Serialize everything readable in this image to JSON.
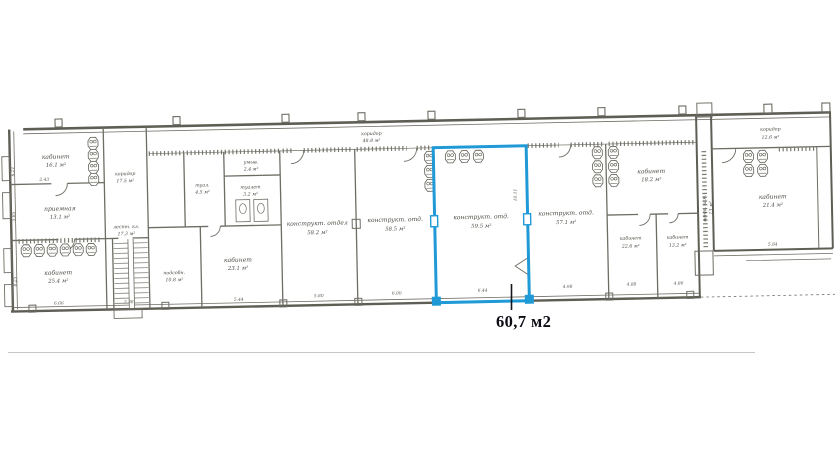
{
  "highlight": {
    "area_label": "60,7 м2",
    "color": "#1f9ad6"
  },
  "rooms": [
    {
      "name": "кабинет",
      "area": "16.1 м²"
    },
    {
      "name": "приемная",
      "area": "13.1 м²"
    },
    {
      "name": "кабинет",
      "area": "25.4 м²"
    },
    {
      "name": "коридор",
      "area": "17.5 м²"
    },
    {
      "name": "лестн. кл.",
      "area": "17.3 м²"
    },
    {
      "name": "подсобн.",
      "area": "10.8 м²"
    },
    {
      "name": "кабинет",
      "area": "23.1 м²"
    },
    {
      "name": "туал.",
      "area": "4.5 м²"
    },
    {
      "name": "умыв.",
      "area": "2.4 м²"
    },
    {
      "name": "туалет",
      "area": "3.2 м²"
    },
    {
      "name": "коридор",
      "area": "48.8 м²"
    },
    {
      "name": "конструкт. отдел",
      "area": "58.2 м²"
    },
    {
      "name": "конструкт. отд.",
      "area": "58.5 м²"
    },
    {
      "name": "конструкт. отд.",
      "area": "59.5 м²"
    },
    {
      "name": "конструкт. отд.",
      "area": "57.1 м²"
    },
    {
      "name": "кабинет",
      "area": "18.2 м²"
    },
    {
      "name": "кабинет",
      "area": "22.6 м²"
    },
    {
      "name": "кабинет",
      "area": "13.2 м²"
    },
    {
      "name": "вент. кам.",
      "area": "13 м²"
    },
    {
      "name": "коридор",
      "area": "12.6 м²"
    },
    {
      "name": "кабинет",
      "area": "21.4 м²"
    }
  ],
  "dimensions": [
    "6.66",
    "2.38",
    "5.44",
    "5.80",
    "6.00",
    "6.44",
    "4.98",
    "4.88",
    "4.86",
    "5.84",
    "6.21",
    "5.85",
    "8.25",
    "10.11",
    "2.43"
  ]
}
